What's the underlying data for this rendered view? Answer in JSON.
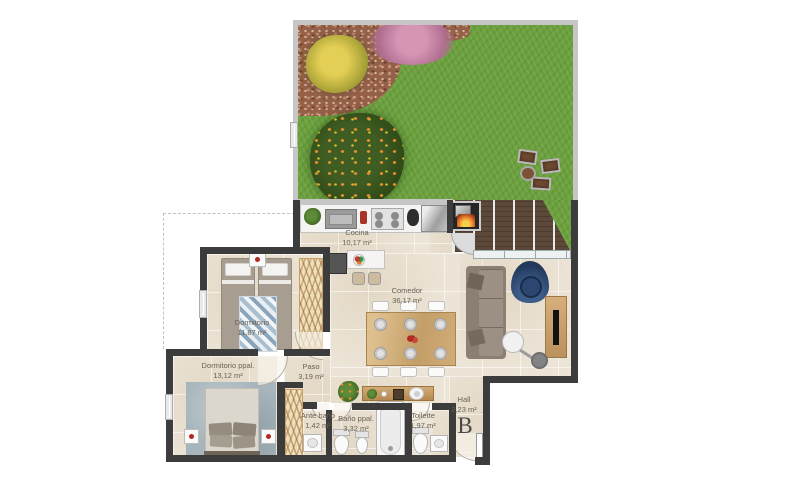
{
  "plan": {
    "unit_label": "B",
    "rooms": [
      {
        "id": "cocina",
        "name": "Cocina",
        "area": "10,17 m²"
      },
      {
        "id": "comedor",
        "name": "Comedor",
        "area": "36,17 m²"
      },
      {
        "id": "dormitorio",
        "name": "Dormitorio",
        "area": "11,87 m²"
      },
      {
        "id": "dormitorio-ppal",
        "name": "Dormitorio ppal.",
        "area": "13,12 m²"
      },
      {
        "id": "paso",
        "name": "Paso",
        "area": "3,19 m²"
      },
      {
        "id": "ante-bano",
        "name": "Ante baño",
        "area": "1,42 m²"
      },
      {
        "id": "bano-ppal",
        "name": "Baño ppal.",
        "area": "3,32 m²"
      },
      {
        "id": "toilette",
        "name": "Toilette",
        "area": "1,97 m²"
      },
      {
        "id": "hall",
        "name": "Hall",
        "area": "2,23 m²"
      }
    ],
    "colors": {
      "grass": "#6BA03D",
      "deck_wood": "#5D4939",
      "wall": "#3C3C3C",
      "garden_wall": "#C6C6C6",
      "floor": "#ECE4D6",
      "wood_furniture": "#C9A06B",
      "armchair_blue": "#22395B",
      "label_text": "#6A6156"
    }
  }
}
